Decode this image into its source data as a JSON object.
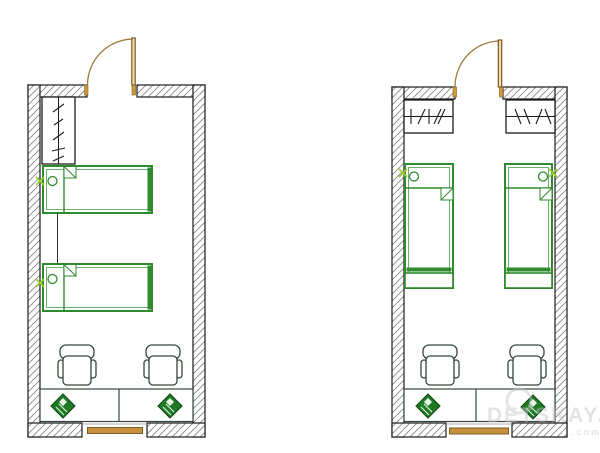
{
  "image": {
    "type": "floor-plan-drawing",
    "description": "Two furnished layout variants of one narrow room shown side by side",
    "width": 600,
    "height": 453
  },
  "watermark": {
    "text": "DETSKAYA",
    "suffix": ".com",
    "logo": "ring-logo"
  },
  "colors": {
    "wall_outline": "#1c1c1c",
    "wall_hatch": "#8a8a8a",
    "furniture_green": "#2e8b2e",
    "furniture_green_light": "#6fae6f",
    "furniture_green_dark": "#1e7a24",
    "furniture_green_darker": "#0f4512",
    "furniture_outline": "#37463a",
    "door_wood": "#9c7a3a",
    "door_frame": "#7a5c22",
    "door_leaf_fill": "#f0ddb0",
    "door_jamb": "#d29a3a",
    "window_fill": "#c8913f",
    "socket_green": "#9acd32",
    "watermark_gray": "#c4c4c4"
  },
  "plans": [
    {
      "id": "variant-1",
      "door_position": "top wall, leaf swings inward to the left",
      "window_position": "bottom wall center",
      "furniture_counts": {
        "wardrobes": 1,
        "beds": 2,
        "office_chairs": 2,
        "desk_sections": 2,
        "computers": 2,
        "socket_markers": 2
      },
      "bed_orientation": "horizontal, stacked along left wall"
    },
    {
      "id": "variant-2",
      "door_position": "top wall, leaf swings inward to the left",
      "window_position": "bottom wall center",
      "furniture_counts": {
        "wardrobes": 2,
        "beds": 2,
        "office_chairs": 2,
        "desk_sections": 2,
        "computers": 2,
        "socket_markers": 2
      },
      "bed_orientation": "vertical, along opposite side walls"
    }
  ]
}
